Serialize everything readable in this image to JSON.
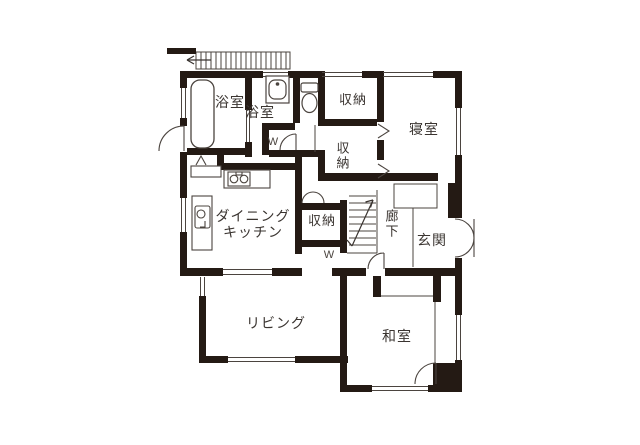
{
  "floorplan": {
    "rooms": {
      "bathroom": {
        "label": "浴室"
      },
      "washroom": {
        "label": "浴室"
      },
      "storage_top": {
        "label": "収納"
      },
      "bedroom": {
        "label": "寝室"
      },
      "storage_closet": {
        "label": "収納"
      },
      "dining_kitchen": {
        "line1": "ダイニング",
        "line2": "キッチン"
      },
      "storage_hall": {
        "label": "収納"
      },
      "corridor": {
        "label": "廊下"
      },
      "entrance": {
        "label": "玄関"
      },
      "living": {
        "label": "リビング"
      },
      "japanese_room": {
        "label": "和室"
      }
    },
    "markers": {
      "bifold_door": "W"
    },
    "colors": {
      "wall": "#241a14",
      "line": "#4b443f",
      "text": "#3a3430",
      "background": "#ffffff"
    }
  }
}
